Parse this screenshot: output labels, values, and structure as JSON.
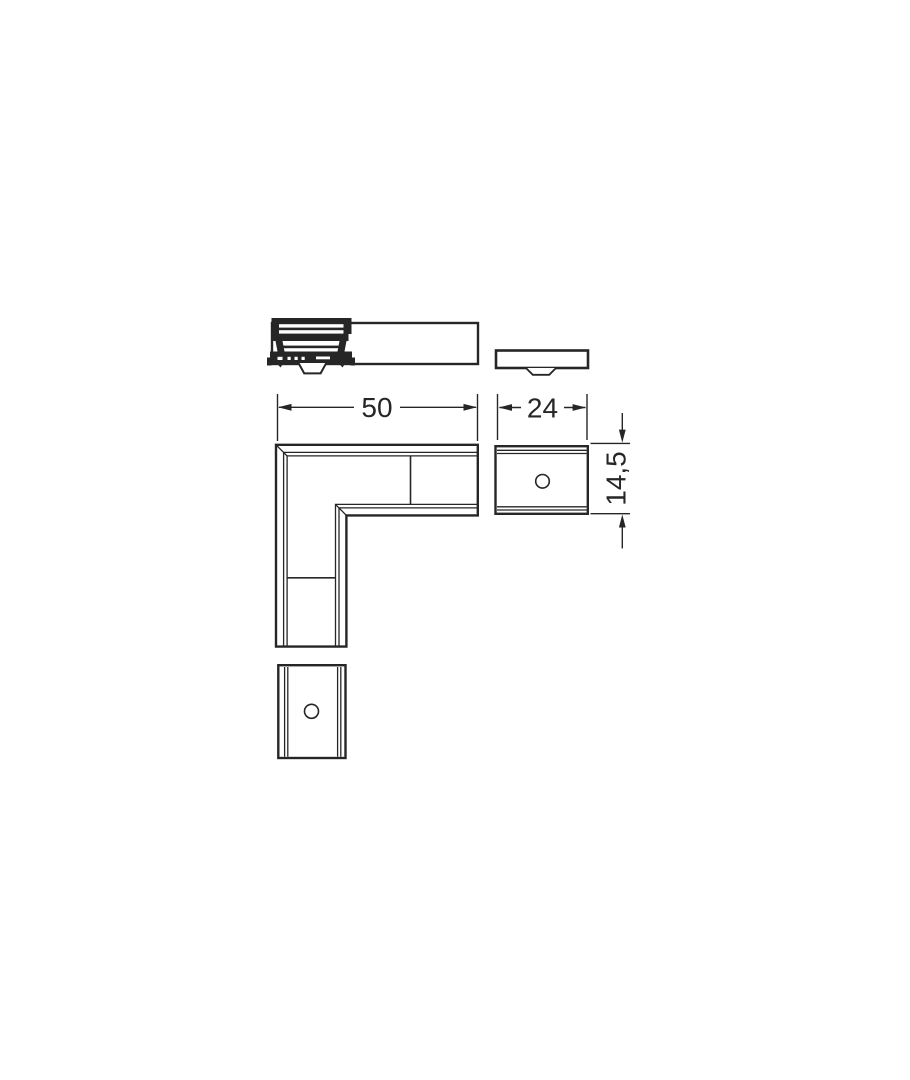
{
  "drawing": {
    "dimensions": {
      "length": "50",
      "width": "24",
      "height": "14,5"
    },
    "colors": {
      "line": "#262626",
      "background": "#ffffff"
    }
  }
}
